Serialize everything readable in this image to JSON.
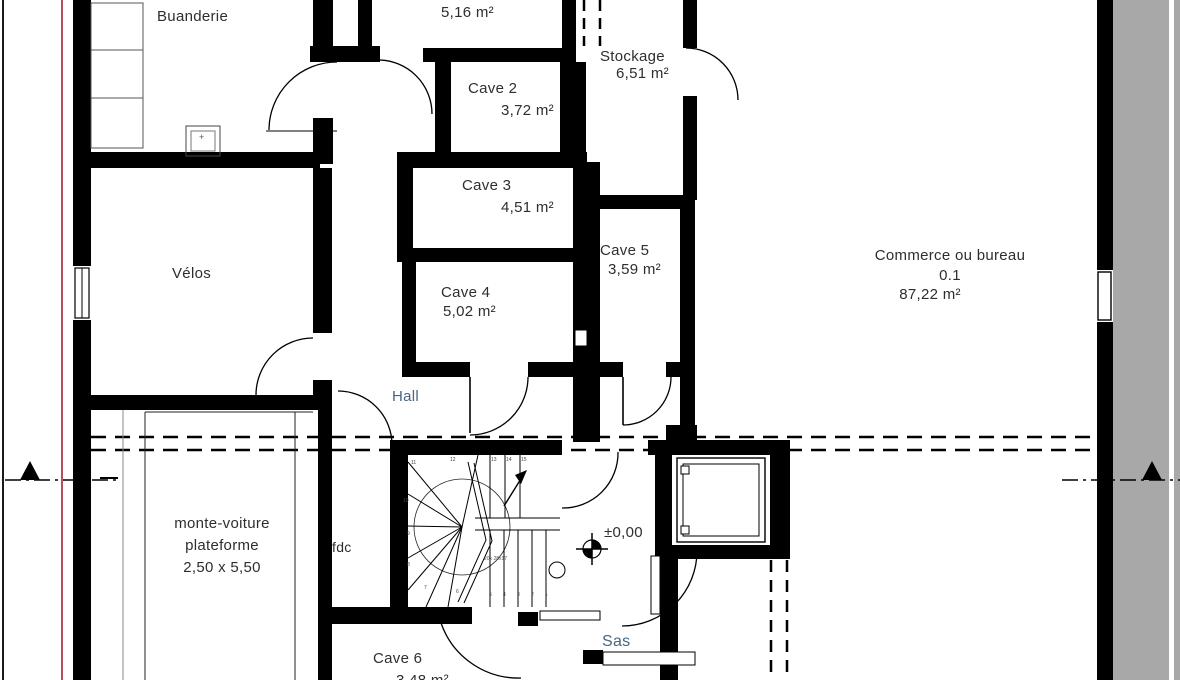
{
  "rooms": {
    "buanderie": {
      "label": "Buanderie"
    },
    "cave1": {
      "area": "5,16 m²"
    },
    "stockage": {
      "label": "Stockage",
      "area": "6,51 m²"
    },
    "cave2": {
      "label": "Cave 2",
      "area": "3,72 m²"
    },
    "cave3": {
      "label": "Cave 3",
      "area": "4,51 m²"
    },
    "cave4": {
      "label": "Cave 4",
      "area": "5,02 m²"
    },
    "cave5": {
      "label": "Cave 5",
      "area": "3,59 m²"
    },
    "commerce": {
      "label": "Commerce ou bureau",
      "unit": "0.1",
      "area": "87,22 m²"
    },
    "velos": {
      "label": "Vélos"
    },
    "hall": {
      "label": "Hall"
    },
    "monte_voiture": {
      "label": "monte-voiture",
      "label2": "plateforme",
      "dimensions": "2,50 x 5,50"
    },
    "fdc": {
      "label": "fdc"
    },
    "sas": {
      "label": "Sas"
    },
    "cave6": {
      "label": "Cave 6",
      "area": "3,48 m²"
    }
  },
  "annotations": {
    "level_marker": "±0,00",
    "stair_note": "20x 28x17",
    "meter_box": "+",
    "stair_treads": [
      "1",
      "2",
      "3",
      "4",
      "5",
      "6",
      "7",
      "8",
      "9",
      "10",
      "11",
      "12",
      "13",
      "14",
      "15"
    ]
  },
  "colors": {
    "wall": "#000000",
    "boundary_red": "#b3505a",
    "margin_gray": "#a8a8a8"
  }
}
